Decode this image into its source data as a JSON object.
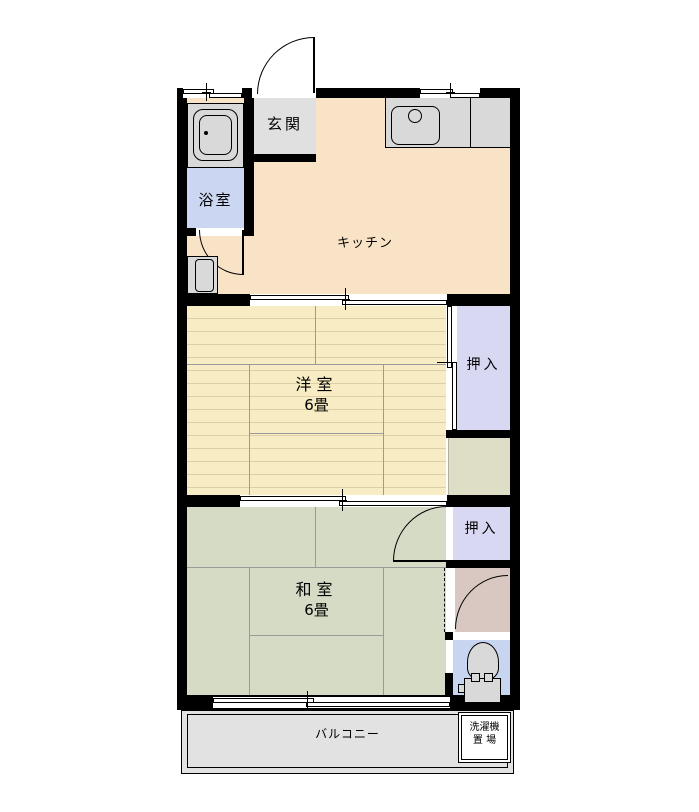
{
  "rooms": {
    "genkan": {
      "label": "玄関"
    },
    "bathroom": {
      "label": "浴室"
    },
    "kitchen": {
      "label": "キッチン"
    },
    "western": {
      "label": "洋室",
      "size": "6畳"
    },
    "closet_upper": {
      "label": "押入"
    },
    "closet_lower": {
      "label": "押入"
    },
    "japanese": {
      "label": "和室",
      "size": "6畳"
    },
    "balcony": {
      "label": "バルコニー"
    },
    "laundry": {
      "line1": "洗濯機",
      "line2": "置 場"
    }
  },
  "fixtures": {
    "bathtub": "bathtub-icon",
    "kitchen_sink": "sink-icon",
    "toilet": "toilet-icon",
    "entrance_door": "hinged-door-arc",
    "bathroom_door": "hinged-door-arc",
    "closet_lower_door": "hinged-door-arc",
    "toilet_door": "hinged-door-arc",
    "sliding_windows": "sliding-window-symbol"
  },
  "colors": {
    "wall": "#000000",
    "kitchen_floor": "#f9e3c6",
    "genkan_floor": "#e0e0e0",
    "bathroom_floor": "#cbd7f2",
    "western_floor": "#f7ecc3",
    "closet_floor": "#d8d8f2",
    "japanese_floor": "#d6dbc5",
    "hallway_floor": "#d9c8c1",
    "toilet_floor": "#c7d5f0",
    "balcony_floor": "#e2e2e2",
    "fixture_fill": "#d9d9d9",
    "service_area": "#deddc6"
  }
}
